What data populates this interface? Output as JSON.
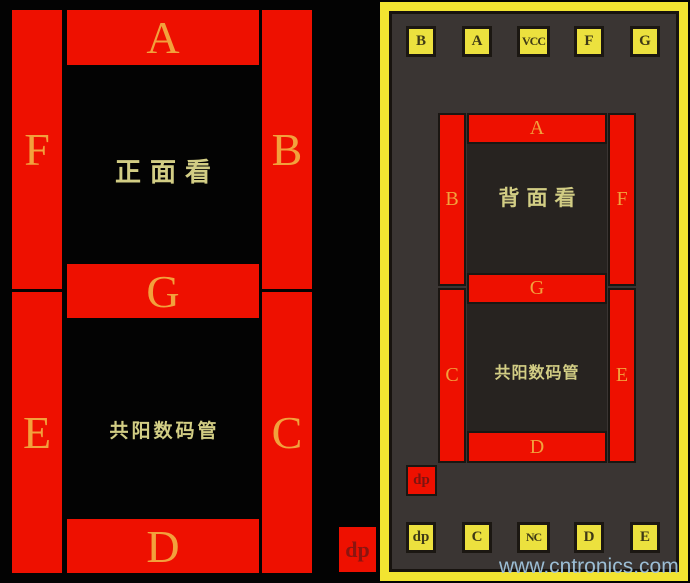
{
  "front": {
    "title": "正面看",
    "type_label": "共阳数码管",
    "segments": {
      "a": "A",
      "b": "B",
      "c": "C",
      "d": "D",
      "e": "E",
      "f": "F",
      "g": "G",
      "dp": "dp"
    }
  },
  "back": {
    "title": "背面看",
    "type_label": "共阳数码管",
    "top_pins": [
      "B",
      "A",
      "VCC",
      "F",
      "G"
    ],
    "bottom_pins": [
      "dp",
      "C",
      "NC",
      "D",
      "E"
    ],
    "segments": {
      "a": "A",
      "b": "B",
      "c": "C",
      "d": "D",
      "e": "E",
      "f": "F",
      "g": "G",
      "dp": "dp"
    }
  },
  "watermark": "www.cntronics.com",
  "colors": {
    "segment_red": "#ee1000",
    "panel_yellow": "#f2e431",
    "pin_yellow": "#ece13e",
    "letter_orange": "#f2a13c",
    "chinese_khaki": "#d2cd84",
    "dp_dark_red": "#8b1510",
    "panel_gray": "#3a3533",
    "watermark_blue": "#a4c9e2"
  }
}
